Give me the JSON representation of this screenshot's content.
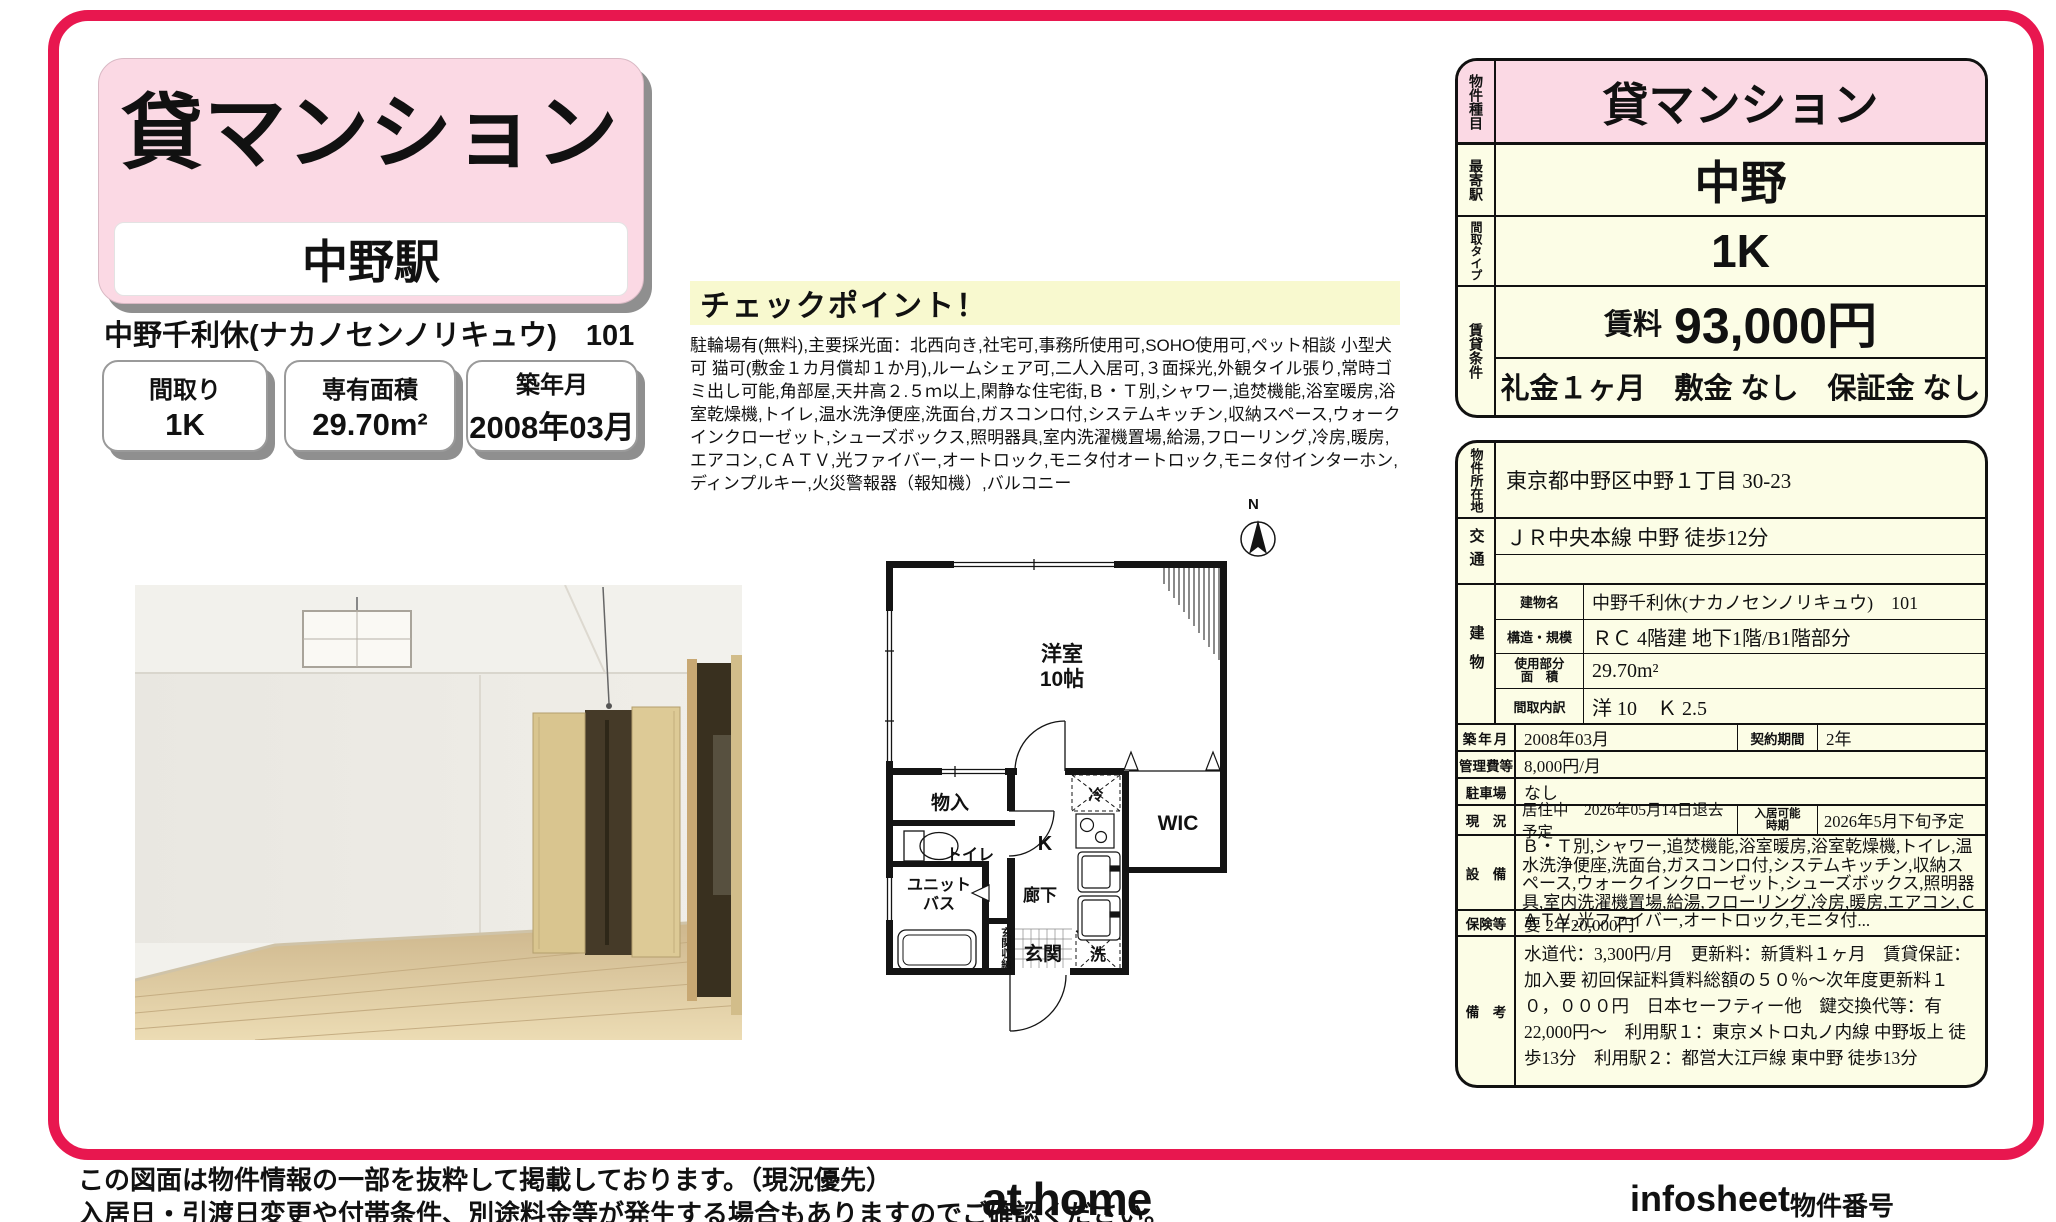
{
  "colors": {
    "accent": "#e8174f",
    "title_pink": "#fbd9e4",
    "table_cream": "#fcfde6",
    "checkpoint_yellow": "#f8f9cf"
  },
  "header": {
    "property_type": "貸マンション",
    "station": "中野駅",
    "building_line": "中野千利休(ナカノセンノリキュウ)　101",
    "badges": [
      {
        "label": "間取り",
        "value": "1K"
      },
      {
        "label": "専有面積",
        "value": "29.70m²"
      },
      {
        "label": "築年月",
        "value": "2008年03月"
      }
    ]
  },
  "checkpoint": {
    "title": "チェックポイント！",
    "body": "駐輪場有(無料),主要採光面：北西向き,社宅可,事務所使用可,SOHO使用可,ペット相談 小型犬可 猫可(敷金１カ月償却１か月),ルームシェア可,二人入居可,３面採光,外観タイル張り,常時ゴミ出し可能,角部屋,天井高２.５ｍ以上,閑静な住宅街,Ｂ・Ｔ別,シャワー,追焚機能,浴室暖房,浴室乾燥機,トイレ,温水洗浄便座,洗面台,ガスコンロ付,システムキッチン,収納スペース,ウォークインクローゼット,シューズボックス,照明器具,室内洗濯機置場,給湯,フローリング,冷房,暖房,エアコン,ＣＡＴＶ,光ファイバー,オートロック,モニタ付オートロック,モニタ付インターホン,ディンプルキー,火災警報器（報知機）,バルコニー"
  },
  "floorplan": {
    "compass": "N",
    "room_main": "洋室",
    "room_main_size": "10帖",
    "closet": "物入",
    "toilet": "トイレ",
    "unit_bath": "ユニット\nバス",
    "kitchen": "K",
    "hallway": "廊下",
    "entrance_storage": "玄関収納",
    "entrance": "玄関",
    "washer": "洗",
    "fridge": "冷",
    "wic": "WIC"
  },
  "summary_table": {
    "type_label": "物件種目",
    "type_value": "貸マンション",
    "station_label": "最寄駅",
    "station_value": "中野",
    "layout_label": "間取タイプ",
    "layout_value": "1K",
    "terms_label": "賃貸条件",
    "rent_label": "賃料",
    "rent_value": "93,000円",
    "terms_value": "礼金１ヶ月　敷金 なし　保証金 なし"
  },
  "detail_table": {
    "location_label": "物件所在地",
    "location": "東京都中野区中野１丁目 30-23",
    "access_label": "交通",
    "access": "ＪＲ中央本線 中野 徒歩12分",
    "building_label": "建物",
    "building_name_label": "建物名",
    "building_name": "中野千利休(ナカノセンノリキュウ)　101",
    "structure_label": "構造・規模",
    "structure": "ＲＣ 4階建 地下1階/B1階部分",
    "area_label": "使用部分\n面　積",
    "area": "29.70m²",
    "layout_detail_label": "間取内訳",
    "layout_detail": "洋 10　Ｋ 2.5",
    "built_label": "築年月",
    "built": "2008年03月",
    "contract_label": "契約期間",
    "contract": "2年",
    "fee_label": "管理費等",
    "fee": "8,000円/月",
    "parking_label": "駐車場",
    "parking": "なし",
    "status_label": "現　況",
    "status": "居住中　2026年05月14日退去予定",
    "movein_label": "入居可能\n時期",
    "movein": "2026年5月下旬予定",
    "equipment_label": "設　備",
    "equipment": "Ｂ・Ｔ別,シャワー,追焚機能,浴室暖房,浴室乾燥機,トイレ,温水洗浄便座,洗面台,ガスコンロ付,システムキッチン,収納スペース,ウォークインクローゼット,シューズボックス,照明器具,室内洗濯機置場,給湯,フローリング,冷房,暖房,エアコン,ＣＡＴＶ,光ファイバー,オートロック,モニタ付...",
    "insurance_label": "保険等",
    "insurance": "要 2年20,000円",
    "notes_label": "備　考",
    "notes": "水道代：3,300円/月　更新料：新賃料１ヶ月　賃貸保証：加入要 初回保証料賃料総額の５０％～次年度更新料１０，０００円　日本セーフティー他　鍵交換代等：有　22,000円～　利用駅１：東京メトロ丸ノ内線 中野坂上 徒歩13分　利用駅２：都営大江戸線 東中野 徒歩13分"
  },
  "footer": {
    "disclaimer_line1": "この図面は物件情報の一部を抜粋して掲載しております。（現況優先）",
    "disclaimer_line2": "入居日・引渡日変更や付帯条件、別途料金等が発生する場合もありますのでご確認ください。",
    "logo": "at home",
    "infosheet": "infosheet",
    "property_number": "物件番号　69741602082"
  }
}
